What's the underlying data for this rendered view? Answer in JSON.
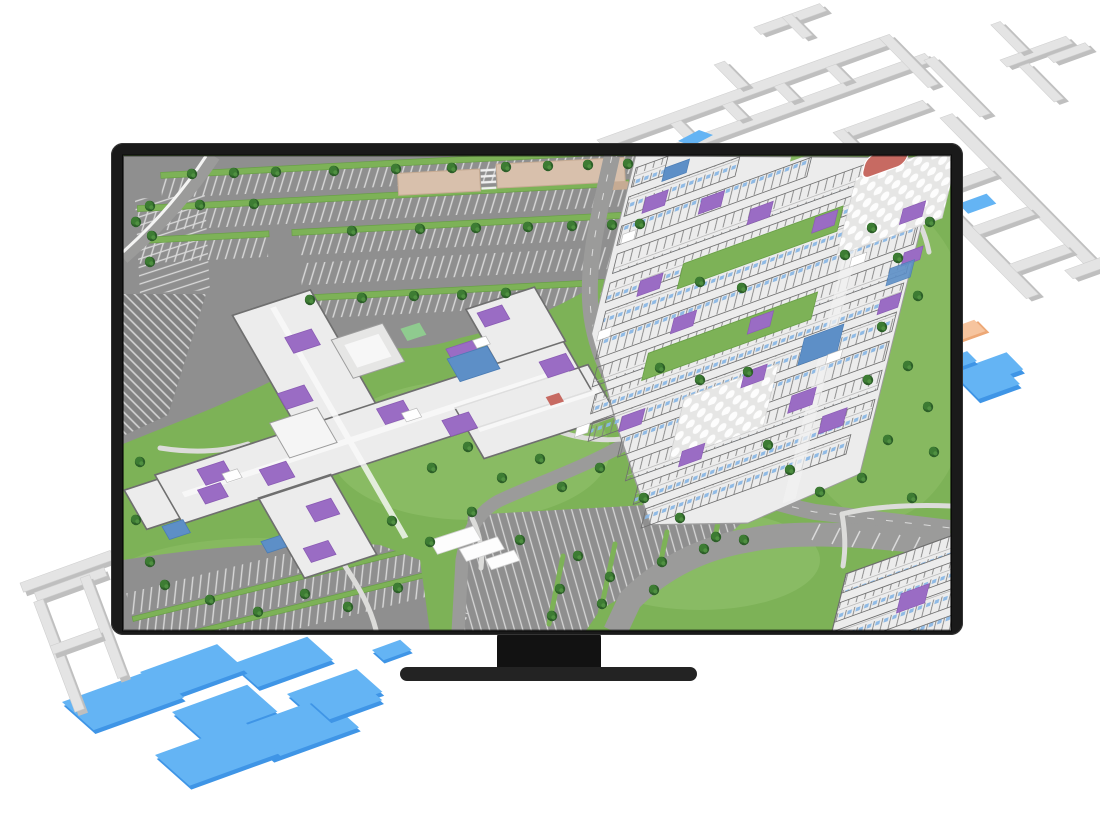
{
  "scene": {
    "kind": "isometric-campus-map-illustration",
    "elements": [
      "monitor-with-stand",
      "campus-map-on-screen",
      "floorplan-walls-beyond-screen",
      "blue-floor-slabs",
      "peach-floor-slab"
    ]
  },
  "palette": {
    "page_bg": "#ffffff",
    "bezel": "#1a1a1a",
    "bezel_edge": "#343434",
    "stand_neck": "#121212",
    "stand_base": "#232323",
    "grass": "#7db257",
    "grass_light": "#8fbf68",
    "grass_pale": "#9cc778",
    "asphalt": "#8f8f8f",
    "asphalt_dark": "#838383",
    "road": "#9b9b9a",
    "stall_line": "#d9d9d9",
    "path": "#dcdcda",
    "median": "#7db257",
    "median_edge": "#699f47",
    "tree_dark": "#2c5f28",
    "tree_mid": "#3d7c33",
    "tree_light": "#549544",
    "tan_roof": "#d8c0ac",
    "tan_edge": "#c6ab93",
    "bldg_floor": "#ececec",
    "bldg_floor2": "#f5f5f5",
    "wall": "#6f6f6f",
    "plaza": "#e6e6e5",
    "room_purple": "#9a6cc4",
    "room_purple_dk": "#8a5bb4",
    "room_blue": "#5d8fc7",
    "tick_blue": "#8ab7e4",
    "room_green": "#8fcb8f",
    "room_red": "#c76a62",
    "out_wall_top": "#e4e4e4",
    "out_wall_side": "#bfbfbf",
    "slab_blue": "#64b4f4",
    "slab_blue_side": "#3f95e6",
    "peach": "#f6c49e",
    "peach_side": "#eda876"
  }
}
